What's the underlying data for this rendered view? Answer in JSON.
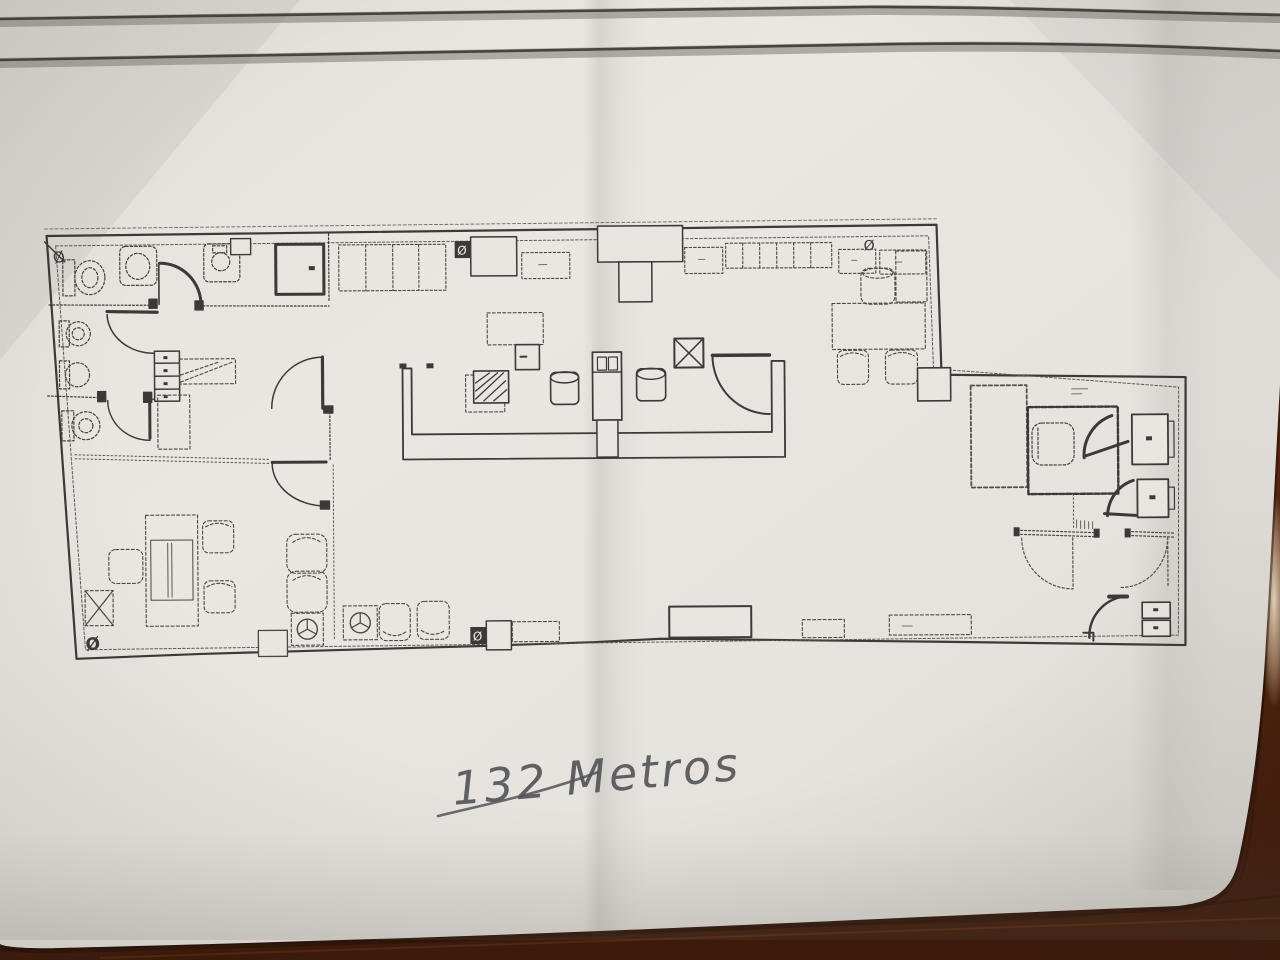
{
  "annotation": {
    "text": "132 Metros"
  },
  "symbols": {
    "diameter_glyph": "Ø"
  },
  "colors": {
    "paper": "#e7e4df",
    "plan_ink": "#3b3a36",
    "header_rule": "#45443f",
    "pen_ink": "#54555a",
    "wood": "#52230e"
  },
  "header": {
    "rule_count": "2"
  }
}
